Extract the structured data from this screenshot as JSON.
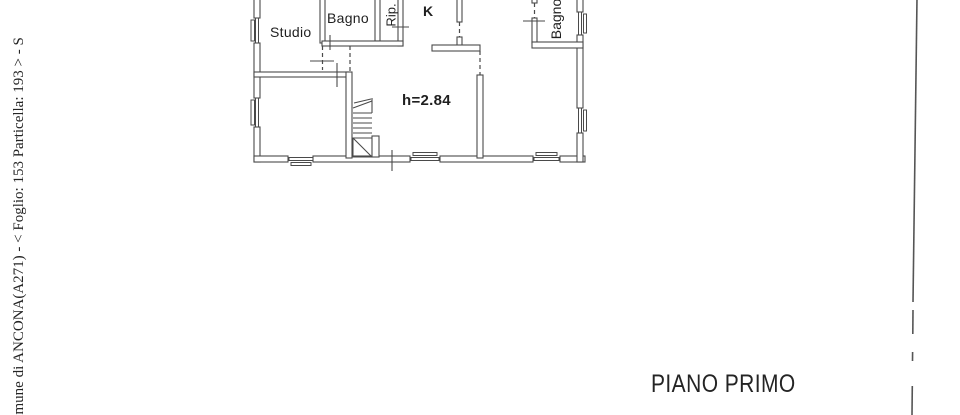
{
  "document": {
    "kind": "scanned cadastral floor plan",
    "background_color": "#ffffff",
    "ink_color": "#4a4a4a",
    "text_color": "#1f1f1f"
  },
  "margin_note": {
    "text": "omune di ANCONA(A271) - < Foglio: 153 Particella: 193 > - S"
  },
  "plan": {
    "room_labels": {
      "studio": "Studio",
      "bagno_top": "Bagno",
      "ripostiglio": "Rip.",
      "kitchen": "K",
      "bagno_right": "Bagno"
    },
    "annotations": {
      "ceiling_height": "h=2.84"
    }
  },
  "footer": {
    "floor_label": "PIANO PRIMO"
  }
}
